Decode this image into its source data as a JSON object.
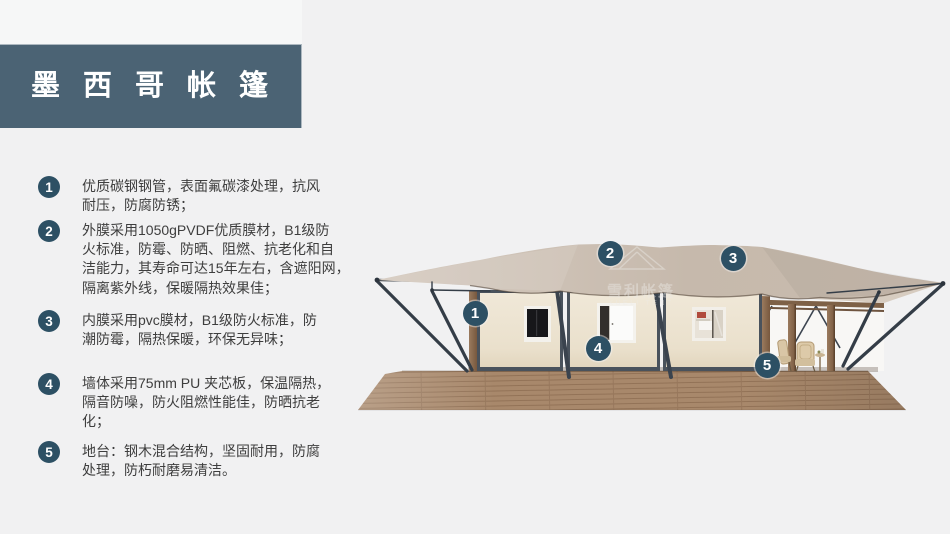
{
  "title": {
    "text": "墨西哥帐篷"
  },
  "features": {
    "items": [
      {
        "num": "1",
        "lines": [
          "优质碳钢钢管，表面氟碳漆处理，抗风",
          "耐压，防腐防锈；"
        ]
      },
      {
        "num": "2",
        "lines": [
          "外膜采用1050gPVDF优质膜材，B1级防",
          "火标准，防霉、防晒、阻燃、抗老化和自",
          "洁能力，其寿命可达15年左右，含遮阳网，",
          "隔离紫外线，保暖隔热效果佳；"
        ]
      },
      {
        "num": "3",
        "lines": [
          "内膜采用pvc膜材，B1级防火标准，防",
          "潮防霉，隔热保暖，环保无异味；"
        ]
      },
      {
        "num": "4",
        "lines": [
          "墙体采用75mm PU 夹芯板，保温隔热，",
          "隔音防噪，防火阻燃性能佳，防晒抗老",
          "化；"
        ]
      },
      {
        "num": "5",
        "lines": [
          "地台：钢木混合结构，坚固耐用，防腐",
          "处理，防朽耐磨易清洁。"
        ]
      }
    ]
  },
  "illustration": {
    "callouts": [
      "1",
      "2",
      "3",
      "4",
      "5"
    ],
    "watermark": {
      "cn": "雪利帐篷",
      "en": "XUELI TENT"
    }
  },
  "colors": {
    "page_bg": "#f1f1f2",
    "title_bg": "#4b6374",
    "badge": "#2d5064",
    "text": "#3e3e3e",
    "roof": "#c9bcaf",
    "wall": "#ece3d1",
    "frame": "#49525c",
    "deck": "#a8886b"
  }
}
